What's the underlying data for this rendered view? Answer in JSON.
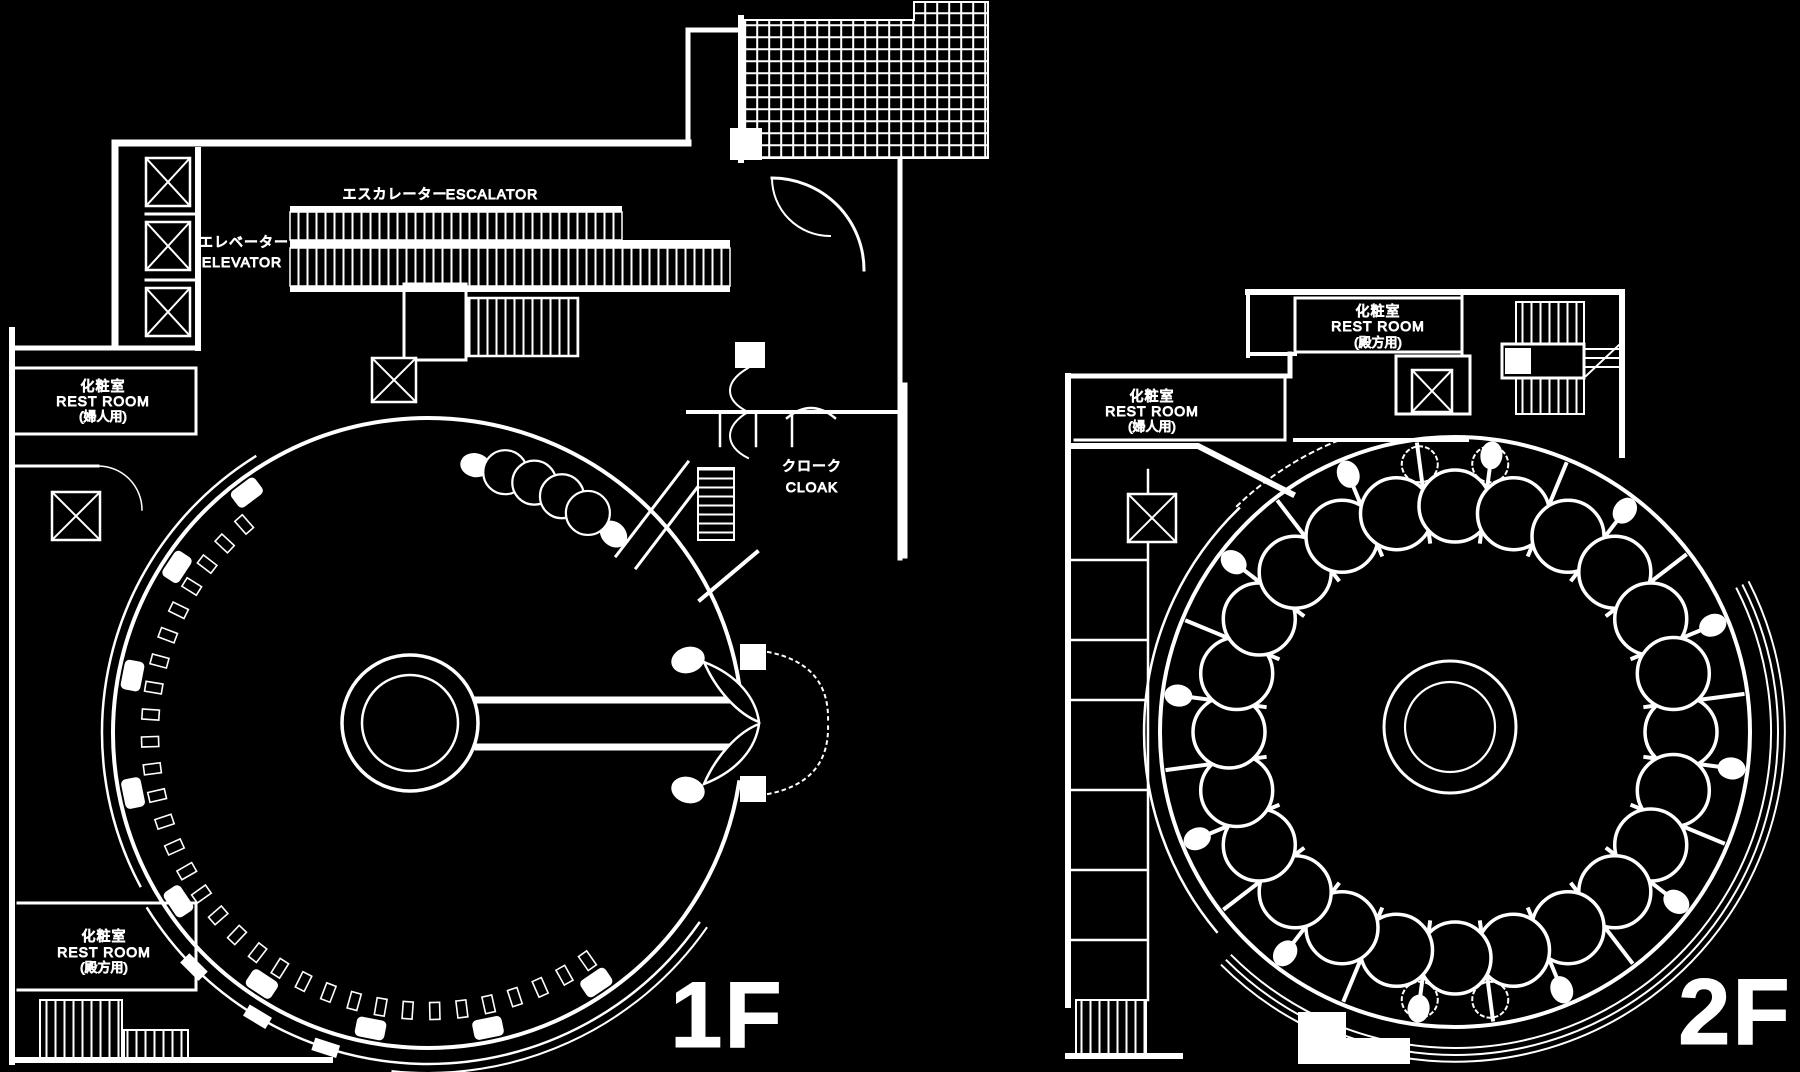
{
  "colors": {
    "background": "#000000",
    "line": "#ffffff"
  },
  "floor1": {
    "floor_label": "1F",
    "escalator": {
      "jp": "エスカレーター",
      "en": "ESCALATOR"
    },
    "elevator": {
      "jp": "エレベーター",
      "en": "ELEVATOR"
    },
    "restroom_women": {
      "jp": "化粧室",
      "en": "REST ROOM",
      "note": "(婦人用)"
    },
    "restroom_men": {
      "jp": "化粧室",
      "en": "REST ROOM",
      "note": "(殿方用)"
    },
    "cloak": {
      "jp": "クローク",
      "en": "CLOAK"
    }
  },
  "floor2": {
    "floor_label": "2F",
    "restroom_men": {
      "jp": "化粧室",
      "en": "REST ROOM",
      "note": "(殿方用)"
    },
    "restroom_women": {
      "jp": "化粧室",
      "en": "REST ROOM",
      "note": "(婦人用)"
    }
  }
}
